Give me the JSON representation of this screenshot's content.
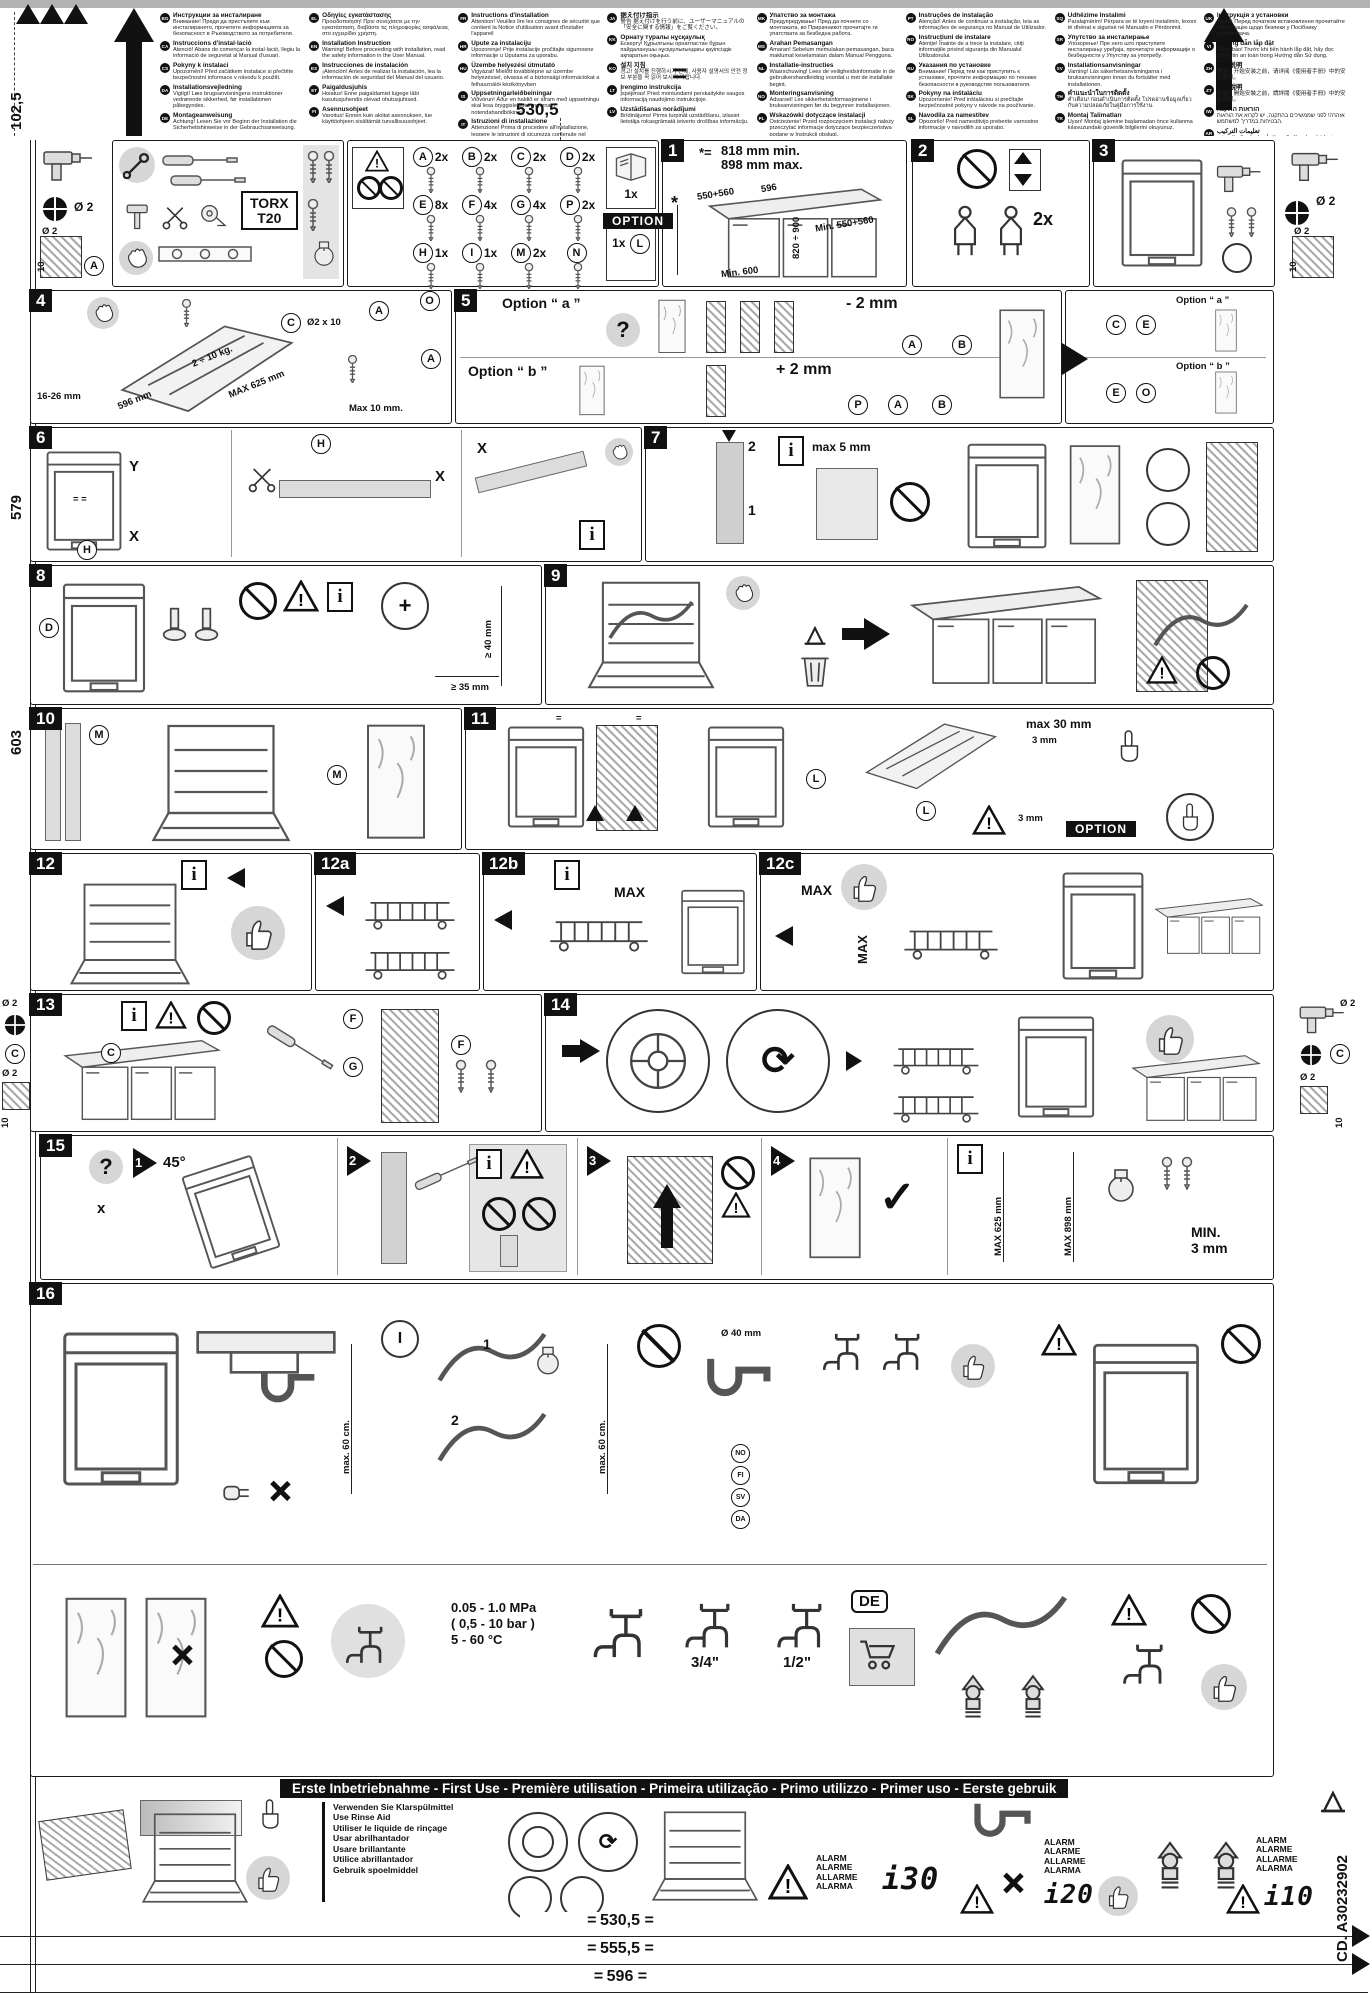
{
  "page": {
    "code_vertical": "CD. A30232902",
    "top_dim": "530,5",
    "eq": "=",
    "left_dims": {
      "d1": "102,5",
      "d2": "579",
      "d3": "603"
    },
    "bottom_dims": {
      "d1": "530,5",
      "d2": "555,5",
      "d3": "596"
    },
    "margin_row1_left": {
      "m1": "Ø 2",
      "m2": "Ø 2",
      "m3": "10",
      "c": "A"
    },
    "margin_row1_right": {
      "m1": "Ø 2",
      "m2": "Ø 2",
      "m3": "10"
    },
    "margin_row7_left": {
      "m1": "Ø 2",
      "c": "C",
      "m2": "Ø 2",
      "m3": "10"
    },
    "margin_row7_right": {
      "m1": "Ø 2",
      "c": "C",
      "m2": "Ø 2",
      "m3": "10"
    }
  },
  "header": {
    "col1": [
      {
        "c": "BG",
        "t": "Инструкции за инсталиране",
        "b": "Внимание! Преди да пристъпите към инсталирането, прочетете информацията за безопасност в Ръководството за потребителя."
      },
      {
        "c": "CA",
        "t": "Instruccions d'instal·lació",
        "b": "Atenció! Abans de començar la instal·lació, llegiu la informació de seguretat al Manual d'usuari."
      },
      {
        "c": "CS",
        "t": "Pokyny k instalaci",
        "b": "Upozornění! Před začátkem instalace si přečtěte bezpečnostní informace v návodu k použití."
      },
      {
        "c": "DA",
        "t": "Installationsvejledning",
        "b": "Vigtigt! Læs brugsanvisningens instruktioner vedrørende sikkerhed, før installationen påbegyndes."
      },
      {
        "c": "DE",
        "t": "Montageanweisung",
        "b": "Achtung! Lesen Sie vor Beginn der Installation die Sicherheitshinweise in der Gebrauchsanweisung."
      }
    ],
    "col2": [
      {
        "c": "EL",
        "t": "Οδηγίες εγκατάστασης",
        "b": "Προειδοποίηση! Πριν συνεχίσετε με την εγκατάσταση, διαβάστε τις πληροφορίες ασφάλειας στο εγχειρίδιο χρήστη."
      },
      {
        "c": "EN",
        "t": "Installation Instruction",
        "b": "Warning! Before proceeding with installation, read the safety information in the User Manual."
      },
      {
        "c": "ES",
        "t": "Instrucciones de instalación",
        "b": "¡Atención! Antes de realizar la instalación, lea la información de seguridad del Manual del usuario."
      },
      {
        "c": "ET",
        "t": "Paigaldusjuhis",
        "b": "Hoiatus! Enne paigaldamist lugege läbi kasutusjuhendis olevad ohutusjuhised."
      },
      {
        "c": "FI",
        "t": "Asennusohjeet",
        "b": "Varoitus! Ennen kuin aloitat asennuksen, lue käyttöohjeen sisältämät turvallisuusohjeet."
      }
    ],
    "col3": [
      {
        "c": "FR",
        "t": "Instructions d'installation",
        "b": "Attention! Veuillez lire les consignes de sécurité que contient la Notice d'utilisation avant d'installer l'appareil"
      },
      {
        "c": "HR",
        "t": "Upute za instalaciju",
        "b": "Upozorenje! Prije instalacije pročitajte sigurnosne informacije u Uputama za uporabu."
      },
      {
        "c": "HU",
        "t": "Üzembe helyezési útmutató",
        "b": "Vigyázat! Mielőtt továbblépne az üzembe helyezéssel, olvassa el a biztonsági információkat a felhasználói kézikönyvben"
      },
      {
        "c": "IS",
        "t": "Uppsetningarleiðbeiningar",
        "b": "Viðvörun! Áður en haldið er áfram með uppsetningu skal lesa öryggisleiðbeiningarnar í notendahandbókinni."
      },
      {
        "c": "IT",
        "t": "Istruzioni di installazione",
        "b": "Attenzione! Prima di procedere all'installazione, leggere le istruzioni di sicurezza contenute nel Libretto Istruzioni."
      }
    ],
    "col4": [
      {
        "c": "JA",
        "t": "据え付け指示",
        "b": "警告 据え付けを行う前に、ユーザーマニュアルの「安全に関する情報」をご覧ください。"
      },
      {
        "c": "KK",
        "t": "Орнату туралы нұсқаулық",
        "b": "Ескерту! Құрылғыны орнатпастан бұрын пайдаланушы нұсқаулығындағы қауіпсіздік ақпаратын оқыңыз."
      },
      {
        "c": "KO",
        "t": "설치 지침",
        "b": "경고! 설치를 진행하시기 전에, 사용자 설명서의 안전 정보 부분을 꼭 읽어 보시기 바랍니다."
      },
      {
        "c": "LT",
        "t": "Įrengimo instrukcija",
        "b": "Įspėjimas! Prieš montuodami perskaitykite saugos informaciją naudojimo instrukcijoje."
      },
      {
        "c": "LV",
        "t": "Uzstādīšanas norādījumi",
        "b": "Brīdinājums! Pirms turpināt uzstādīšanu, izlasiet lietotāja rokasgrāmatā ietverto drošības informāciju."
      }
    ],
    "col5": [
      {
        "c": "MK",
        "t": "Упатство за монтажа",
        "b": "Предупредување! Пред да почнете со монтажата, во Прирачникот прочитајте ги упатствата за безбедна работа."
      },
      {
        "c": "MS",
        "t": "Arahan Pemasangan",
        "b": "Amaran! Sebelum memulakan pemasangan, baca maklumat keselamatan dalam Manual Pengguna."
      },
      {
        "c": "NL",
        "t": "Installatie-instructies",
        "b": "Waarschuwing! Lees de veiligheidsinformatie in de gebruikershandleiding voordat u met de installatie begint."
      },
      {
        "c": "NO",
        "t": "Monteringsanvisning",
        "b": "Advarsel! Les sikkerhetsinformasjonene i bruksanvisningen før du begynner installasjonen."
      },
      {
        "c": "PL",
        "t": "Wskazówki dotyczące instalacji",
        "b": "Ostrzeżenie! Przed rozpoczęciem instalacji należy przeczytać informacje dotyczące bezpieczeństwa podane w Instrukcji obsługi."
      }
    ],
    "col6": [
      {
        "c": "PT",
        "t": "Instruções de instalação",
        "b": "Atenção! Antes de continuar a instalação, leia as informações de segurança no Manual de Utilizador."
      },
      {
        "c": "RO",
        "t": "Instrucțiuni de instalare",
        "b": "Atenție! Înainte de a trece la instalare, citiți informațiile privind siguranța din Manualul Utilizatorului."
      },
      {
        "c": "RU",
        "t": "Указания по установке",
        "b": "Внимание! Перед тем как приступить к установке, прочтите информацию по технике безопасности в руководстве пользователя."
      },
      {
        "c": "SK",
        "t": "Pokyny na inštaláciu",
        "b": "Upozornenie! Pred inštaláciou si prečítajte bezpečnostné pokyny v návode na používanie."
      },
      {
        "c": "SL",
        "t": "Navodila za namestitev",
        "b": "Opozorilo! Pred namestitvijo preberite varnostne informacije v navodilih za uporabo."
      }
    ],
    "col7": [
      {
        "c": "SQ",
        "t": "Udhëzime Instalimi",
        "b": "Paralajmërim! Përpara se të kryeni instalimin, lexoni të dhënat e sigurisë në Manualin e Përdorimit."
      },
      {
        "c": "SR",
        "t": "Упутство за инсталирање",
        "b": "Упозорење! Пре него што приступите инсталирању уређаја, прочитајте информације о безбедности у Упутству за употребу."
      },
      {
        "c": "SV",
        "t": "Installationsanvisningar",
        "b": "Varning! Läs säkerhetsanvisningarna i bruksanvisningen innan du fortsätter med installationen."
      },
      {
        "c": "TH",
        "t": "คำแนะนำในการติดตั้ง",
        "b": "คำเตือน! ก่อนดำเนินการติดตั้ง โปรดอ่านข้อมูลเกี่ยวกับความปลอดภัยในคู่มือการใช้งาน"
      },
      {
        "c": "TR",
        "t": "Montaj Talimatları",
        "b": "Uyarı! Montaj işlemine başlamadan önce kullanma kılavuzundaki güvenlik bilgilerini okuyunuz."
      }
    ],
    "col8": [
      {
        "c": "UK",
        "t": "Інструкція з установки",
        "b": "Увага! Перед початком встановлення прочитайте інформацію щодо безпеки у Посібнику користувача."
      },
      {
        "c": "VI",
        "t": "Hướng dẫn lắp đặt",
        "b": "Cảnh báo! Trước khi tiến hành lắp đặt, hãy đọc thông tin an toàn trong Hướng dẫn Sử dụng."
      },
      {
        "c": "ZH",
        "t": "安装说明",
        "b": "警告！开始安装之前，请详阅《使用者手册》中的安全资讯。"
      },
      {
        "c": "ZT",
        "t": "安裝說明",
        "b": "警告！開始安裝之前，請詳閱《使用者手冊》中的安全資訊。"
      },
      {
        "c": "IW",
        "t": "הוראות התקנה",
        "b": "אזהרה! לפני שממשיכים בהתקנה, יש לקרוא את הוראות הבטיחות במדריך למשתמש."
      },
      {
        "c": "AR",
        "t": "تعليمات التركيب",
        "b": "تحذير! قبل متابعة التركيب، اقرأ معلومات السلامة في دليل المستخدم."
      }
    ]
  },
  "tools": {
    "torx1": "TORX",
    "torx2": "T20"
  },
  "parts": {
    "items": [
      {
        "id": "A",
        "qty": "2x"
      },
      {
        "id": "B",
        "qty": "2x"
      },
      {
        "id": "C",
        "qty": "2x"
      },
      {
        "id": "D",
        "qty": "2x"
      },
      {
        "id": "E",
        "qty": "8x"
      },
      {
        "id": "F",
        "qty": "4x"
      },
      {
        "id": "G",
        "qty": "4x"
      },
      {
        "id": "P",
        "qty": "2x"
      },
      {
        "id": "H",
        "qty": "1x"
      },
      {
        "id": "I",
        "qty": "1x"
      },
      {
        "id": "M",
        "qty": "2x"
      },
      {
        "id": "N",
        "qty": ""
      },
      {
        "id": "O",
        "qty": ""
      }
    ],
    "doc_qty": "1x",
    "option": "OPTION",
    "option_qty": "1x",
    "option_id": "L"
  },
  "p1": {
    "num": "1",
    "star": "*=",
    "line1": "818 mm min.",
    "line2": "898 mm max.",
    "d1": "550+560",
    "d2": "596",
    "d3": "820 ÷ 900",
    "d4": "Min. 550+560",
    "d5": "Min. 600",
    "star2": "*"
  },
  "p2": {
    "num": "2",
    "qty": "2x"
  },
  "p3": {
    "num": "3"
  },
  "p4": {
    "num": "4",
    "d1": "Ø2 x 10",
    "d2": "2 ÷ 10 kg.",
    "d3": "MAX 625 mm",
    "d4": "596 mm",
    "d5": "Max 10 mm.",
    "d6": "16-26 mm",
    "c1": "C",
    "c2": "A",
    "c3": "A"
  },
  "p5": {
    "num": "5",
    "oa": "Option “ a ”",
    "ob": "Option “ b ”",
    "da": "- 2 mm",
    "db": "+ 2 mm",
    "q": "?",
    "ca1": "A",
    "ca2": "B",
    "cb1": "P",
    "cb2": "A",
    "cb3": "B"
  },
  "p5b": {
    "oa": "Option “ a ”",
    "ob": "Option “ b ”",
    "c1": "C",
    "c2": "E",
    "c3": "E",
    "c4": "O"
  },
  "p6": {
    "num": "6",
    "x1": "X",
    "x2": "X",
    "x3": "X",
    "y": "Y",
    "h": "H",
    "eq": "= ="
  },
  "p7": {
    "num": "7",
    "n1": "1",
    "n2": "2",
    "d1": "max 5 mm"
  },
  "p8": {
    "num": "8",
    "c1": "D",
    "d1": "≥ 40 mm",
    "d2": "≥ 35 mm",
    "plus": "+"
  },
  "p9": {
    "num": "9"
  },
  "p10": {
    "num": "10",
    "c1": "M",
    "c2": "M"
  },
  "p11": {
    "num": "11",
    "c1": "L",
    "c2": "L",
    "d1": "max 30 mm",
    "d2": "3 mm",
    "d3": "3 mm",
    "opt": "OPTION",
    "eq": "="
  },
  "p12": {
    "num": "12"
  },
  "p12a": {
    "num": "12a"
  },
  "p12b": {
    "num": "12b",
    "max": "MAX"
  },
  "p12c": {
    "num": "12c",
    "max1": "MAX",
    "max2": "MAX"
  },
  "p13": {
    "num": "13",
    "c1": "F",
    "c2": "G",
    "c3": "F",
    "c4": "C"
  },
  "p14": {
    "num": "14"
  },
  "p15": {
    "num": "15",
    "s1": "1",
    "s2": "2",
    "s3": "3",
    "s4": "4",
    "deg": "45°",
    "q": "?",
    "x": "x",
    "check": "✓",
    "min1": "MIN.",
    "min2": "3 mm",
    "max1": "MAX 625 mm",
    "max2": "MAX 898 mm"
  },
  "p16": {
    "num": "16",
    "d1": "max. 60 cm.",
    "d2": "max. 60 cm.",
    "i": "I",
    "n1": "1",
    "n2": "2",
    "spec1": "0.05 - 1.0 MPa",
    "spec2": "( 0,5 - 10 bar )",
    "spec3": "5 - 60 °C",
    "tap1": "3/4\"",
    "tap2": "1/2\"",
    "drain": "Ø 40 mm",
    "de": "DE",
    "countries": [
      "NO",
      "FI",
      "SV",
      "DA"
    ]
  },
  "banner": {
    "text": "Erste Inbetriebnahme - First Use - Première utilisation - Primeira utilização - Primo utilizzo - Primer uso - Eerste gebruik"
  },
  "footer": {
    "rinse": [
      "Verwenden Sie Klarspülmittel",
      "Use Rinse Aid",
      "Utiliser le liquide de rinçage",
      "Usar abrilhantador",
      "Usare brillantante",
      "Utilice abrillantador",
      "Gebruik spoelmiddel"
    ],
    "alarm_words": [
      "ALARM",
      "ALARME",
      "ALLARME",
      "ALARMA"
    ],
    "a1": "i30",
    "a2": "i20",
    "a3": "i10"
  }
}
